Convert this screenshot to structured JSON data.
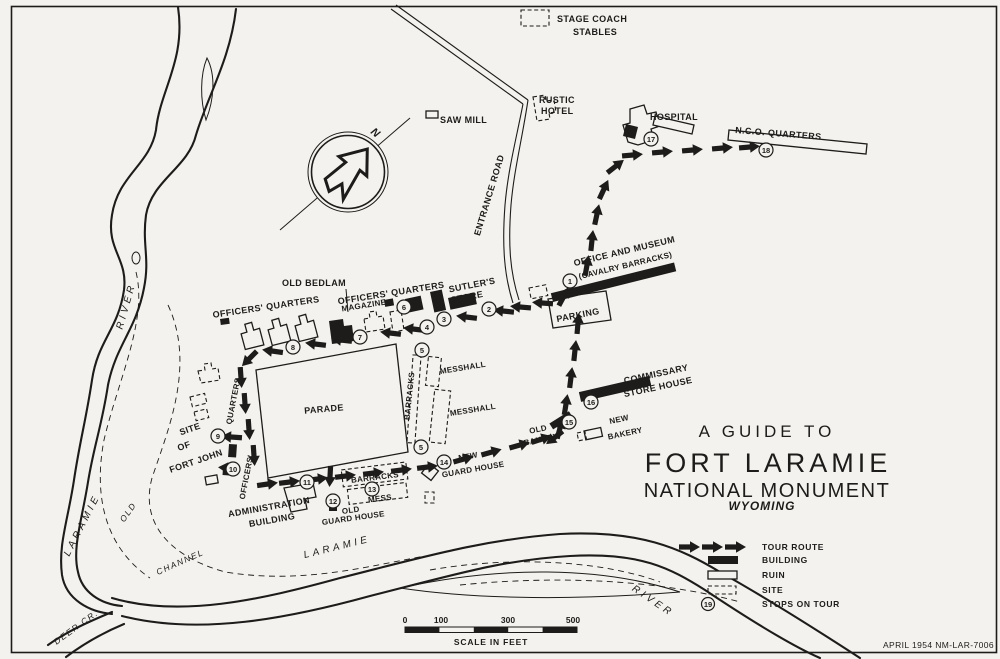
{
  "colors": {
    "paper": "#f4f2ee",
    "ink": "#1d1c1a"
  },
  "title": {
    "line1": "A GUIDE TO",
    "line2": "FORT LARAMIE",
    "line3": "NATIONAL MONUMENT",
    "line4": "WYOMING"
  },
  "stamp": "APRIL 1954  NM-LAR-7006",
  "compass": {
    "north": "N"
  },
  "legend": {
    "tour_route": "TOUR ROUTE",
    "building": "BUILDING",
    "ruin": "RUIN",
    "site": "SITE",
    "stops": "STOPS ON TOUR",
    "stops_example": "19"
  },
  "scale": {
    "ticks": [
      "0",
      "100",
      "300",
      "500"
    ],
    "caption": "SCALE IN FEET"
  },
  "stops": [
    "1",
    "2",
    "3",
    "4",
    "5",
    "6",
    "7",
    "8",
    "9",
    "10",
    "11",
    "12",
    "13",
    "14",
    "15",
    "16",
    "17",
    "18",
    "19"
  ],
  "labels": {
    "stage_coach_1": "STAGE COACH",
    "stage_coach_2": "STABLES",
    "saw_mill": "SAW MILL",
    "rustic_1": "RUSTIC",
    "rustic_2": "HOTEL",
    "hospital": "HOSPITAL",
    "nco": "N.C.O. QUARTERS",
    "entrance_road": "ENTRANCE ROAD",
    "office_1": "OFFICE AND MUSEUM",
    "office_2": "(CAVALRY BARRACKS)",
    "parking": "PARKING",
    "old_bedlam": "OLD BEDLAM",
    "oq_left": "OFFICERS' QUARTERS",
    "oq_mid": "OFFICERS' QUARTERS",
    "magazine": "MAGAZINE",
    "sutlers_1": "SUTLER'S",
    "sutlers_2": "STORE",
    "parade": "PARADE",
    "barracks_v": "BARRACKS",
    "messhall_1": "MESSHALL",
    "messhall_2": "MESSHALL",
    "site_1": "SITE",
    "site_2": "OF",
    "site_3": "FORT JOHN",
    "oq_w1": "QUARTERS",
    "oq_w2": "OFFICERS'",
    "old_bakery_1": "OLD",
    "old_bakery_2": "BAKERY",
    "new_bakery_1": "NEW",
    "new_bakery_2": "BAKERY",
    "commissary_1": "COMMISSARY",
    "commissary_2": "STORE HOUSE",
    "new_gh_1": "NEW",
    "new_gh_2": "GUARD HOUSE",
    "admin_1": "ADMINISTRATION",
    "admin_2": "BUILDING",
    "barracks_s": "BARRACKS",
    "mess": "MESS",
    "old_gh_1": "OLD",
    "old_gh_2": "GUARD HOUSE",
    "river_left_1": "LARAMIE",
    "river_left_2": "RIVER",
    "old_channel_1": "OLD",
    "old_channel_2": "CHANNEL",
    "laramie_bottom": "LARAMIE",
    "river_bottom": "RIVER",
    "deer_cr": "DEER CR."
  }
}
